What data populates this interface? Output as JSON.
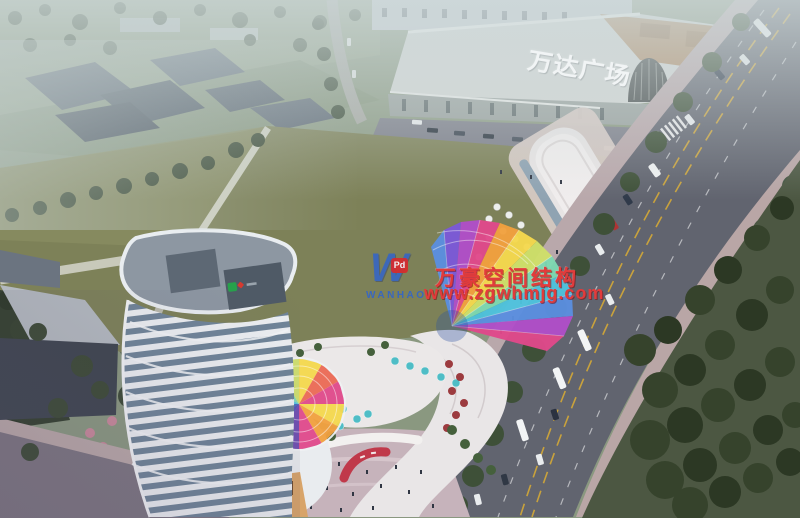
{
  "mall": {
    "sign_text": "万达广场"
  },
  "watermark": {
    "logo_letter": "W",
    "logo_wordmark": "WANHAO",
    "logo_badge_text": "Pd",
    "company_name": "万豪空间结构",
    "website": "www.zgwhmjg.com"
  },
  "colors": {
    "watermark_red": "#e23b3b",
    "watermark_blue": "#2f63cf",
    "badge_red": "#d92b2b",
    "mall_sign_white": "#f4f7f8",
    "field_green": "#7d8158",
    "road_gray": "#61646f",
    "tree_green": "#3a472f",
    "tower_white": "#eceff2",
    "tower_glass": "#6f8498",
    "plaza_pink": "#c6b3bb",
    "canopy_rainbow": [
      "#4fc3de",
      "#5b8fe0",
      "#7b59d8",
      "#b14fc9",
      "#e0498b",
      "#ec6a55",
      "#f2a13f",
      "#f5d94e",
      "#cfe06a",
      "#7ed9b2"
    ]
  }
}
